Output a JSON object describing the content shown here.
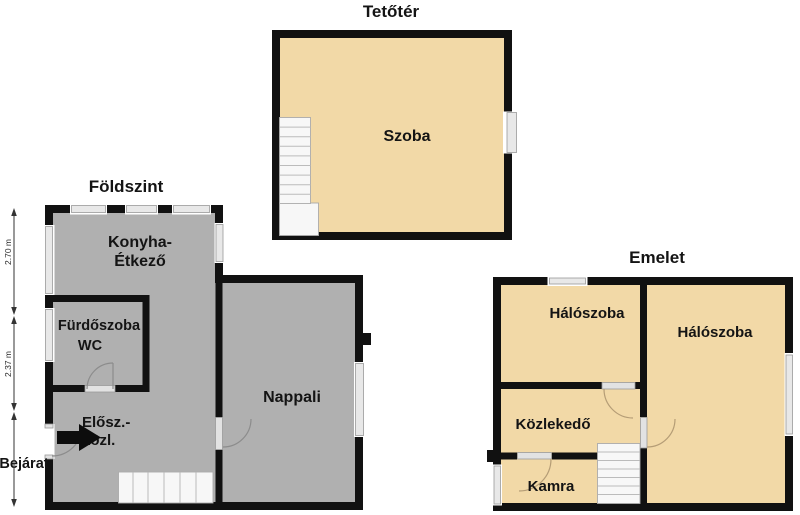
{
  "colors": {
    "wall": "#111111",
    "floor_gray": "#b0b0b0",
    "floor_tan": "#f2d9a7",
    "window_sill": "#e8e8e8",
    "stairs": "#f7f7f7",
    "background": "#ffffff"
  },
  "plans": {
    "attic": {
      "title": "Tetőtér",
      "rooms": {
        "szoba": "Szoba"
      }
    },
    "ground": {
      "title": "Földszint",
      "rooms": {
        "kitchen_line1": "Konyha-",
        "kitchen_line2": "Étkező",
        "bathroom_line1": "Fürdőszoba",
        "bathroom_line2": "WC",
        "hall_line1": "Elősz.-",
        "hall_line2": "közl.",
        "living": "Nappali"
      },
      "entrance_label": "Bejárat",
      "dimensions": [
        "2.70 m",
        "2.37 m"
      ]
    },
    "upper": {
      "title": "Emelet",
      "rooms": {
        "bedroom1": "Hálószoba",
        "bedroom2": "Hálószoba",
        "corridor": "Közlekedő",
        "pantry": "Kamra"
      }
    }
  }
}
